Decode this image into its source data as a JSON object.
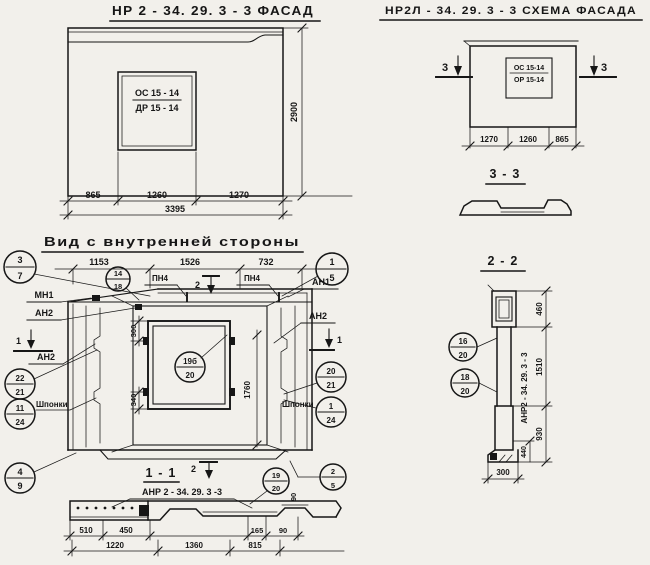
{
  "page": {
    "bg": "#f2f0eb",
    "ink": "#161616"
  },
  "facade": {
    "title": "НР 2 - 34. 29. 3  - 3   ФАСАД",
    "window_top": "ОС 15 - 14",
    "window_bottom": "ДР 15 - 14",
    "dim_865": "865",
    "dim_1260": "1260",
    "dim_1270": "1270",
    "dim_total": "3395",
    "dim_height": "2900"
  },
  "schema": {
    "title": "НР2Л - 34. 29. 3  - 3   СХЕМА ФАСАДА",
    "window_top": "ОС 15-14",
    "window_bottom": "ОР 15-14",
    "dim_1270": "1270",
    "dim_1260": "1260",
    "dim_865": "865",
    "marker": "3"
  },
  "section33": {
    "title": "3 - 3"
  },
  "main_view": {
    "title": "Вид  с  внутренней  стороны",
    "dim_1153": "1153",
    "dim_1526": "1526",
    "dim_732": "732",
    "pn4": "ПН4",
    "mn1": "МН1",
    "an1": "АН1",
    "an2": "АН2",
    "shponki": "Шпонки",
    "marker1": "1",
    "marker2": "2",
    "dim_300": "300",
    "dim_340": "340",
    "dim_1760": "1760",
    "dim_90": "90",
    "b37_t": "3",
    "b37_b": "7",
    "b1418_t": "14",
    "b1418_b": "18",
    "b15_t": "1",
    "b15_b": "5",
    "b2221_t": "22",
    "b2221_b": "21",
    "b1124_t": "11",
    "b1124_b": "24",
    "b2021_t": "20",
    "b2021_b": "21",
    "b124_t": "1",
    "b124_b": "24",
    "b19b20_t": "19б",
    "b19b20_b": "20",
    "b49_t": "4",
    "b49_b": "9",
    "b1920_t": "19",
    "b1920_b": "20",
    "b25_t": "2",
    "b25_b": "5"
  },
  "section11": {
    "title": "1 - 1",
    "label": "АНР 2 - 34. 29. 3  -3",
    "dim_510": "510",
    "dim_450": "450",
    "dim_1220": "1220",
    "dim_1360": "1360",
    "dim_815": "815",
    "dim_165": "165",
    "dim_90": "90"
  },
  "section22": {
    "title": "2 - 2",
    "label": "АНР2 - 34. 29. 3 - 3",
    "dim_460": "460",
    "dim_1510": "1510",
    "dim_930": "930",
    "dim_440": "440",
    "dim_300": "300",
    "b1620_t": "16",
    "b1620_b": "20",
    "b1820_t": "18",
    "b1820_b": "20"
  }
}
